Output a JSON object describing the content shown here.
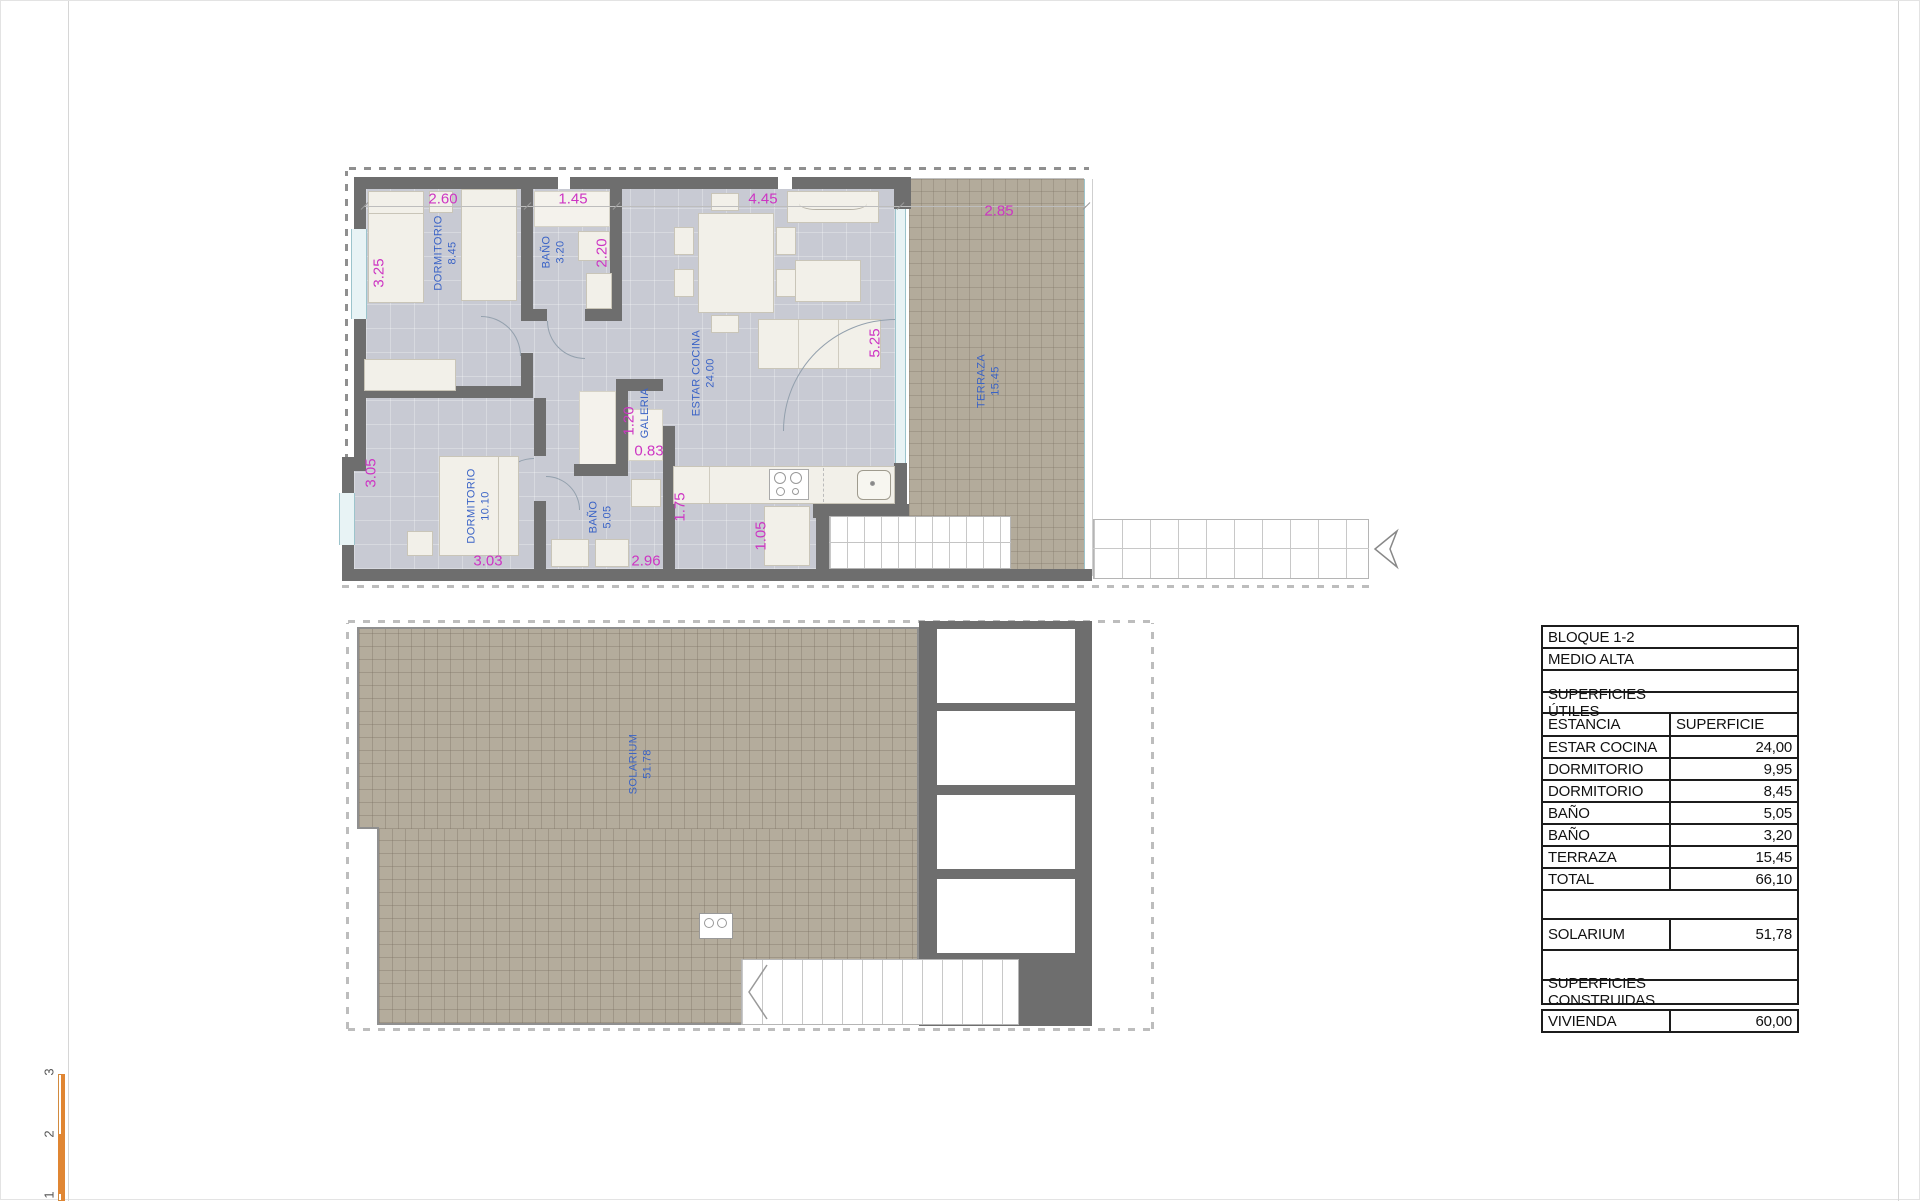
{
  "page": {
    "type": "architectural-floor-plan"
  },
  "plan_upper": {
    "rooms": {
      "dormitorio1": {
        "name": "DORMITORIO",
        "area": "8.45"
      },
      "bano1": {
        "name": "BAÑO",
        "area": "3.20"
      },
      "estar_cocina": {
        "name": "ESTAR COCINA",
        "area": "24.00"
      },
      "terraza": {
        "name": "TERRAZA",
        "area": "15.45"
      },
      "galeria": {
        "name": "GALERIA"
      },
      "dormitorio2": {
        "name": "DORMITORIO",
        "area": "10.10"
      },
      "bano2": {
        "name": "BAÑO",
        "area": "5.05"
      }
    },
    "dims": {
      "top1": "2.60",
      "top2": "1.45",
      "top3": "4.45",
      "top4": "2.85",
      "left1": "3.25",
      "left2": "3.05",
      "v1": "2.20",
      "v2": "5.25",
      "v3": "1.20",
      "v4": "1.75",
      "v5": "1.05",
      "h1": "0.83",
      "h2": "3.03",
      "h3": "2.96"
    }
  },
  "plan_lower": {
    "rooms": {
      "solarium": {
        "name": "SOLARIUM",
        "area": "51.78"
      }
    }
  },
  "summary_table": {
    "title1": "BLOQUE 1-2",
    "title2": "MEDIO ALTA",
    "section1_header": "SUPERFICIES ÚTILES",
    "col_label": "ESTANCIA",
    "col_value": "SUPERFICIE",
    "rows": [
      {
        "label": "ESTAR COCINA",
        "value": "24,00"
      },
      {
        "label": "DORMITORIO",
        "value": "9,95"
      },
      {
        "label": "DORMITORIO",
        "value": "8,45"
      },
      {
        "label": "BAÑO",
        "value": "5,05"
      },
      {
        "label": "BAÑO",
        "value": "3,20"
      },
      {
        "label": "TERRAZA",
        "value": "15,45"
      },
      {
        "label": "TOTAL",
        "value": "66,10"
      }
    ],
    "solarium_row": {
      "label": "SOLARIUM",
      "value": "51,78"
    },
    "section2_header": "SUPERFICIES CONSTRUIDAS",
    "vivienda_row": {
      "label": "VIVIENDA",
      "value": "60,00"
    }
  },
  "scale_bar": {
    "labels": [
      "3",
      "2",
      "1"
    ]
  },
  "colors": {
    "wall": "#6e6e6e",
    "floor": "#c8cad3",
    "terrace": "#b3ab9b",
    "furniture": "#f2f0e9",
    "dimension_text": "#cd35c3",
    "room_text": "#3a63c6",
    "scale_bar": "#e08633"
  }
}
